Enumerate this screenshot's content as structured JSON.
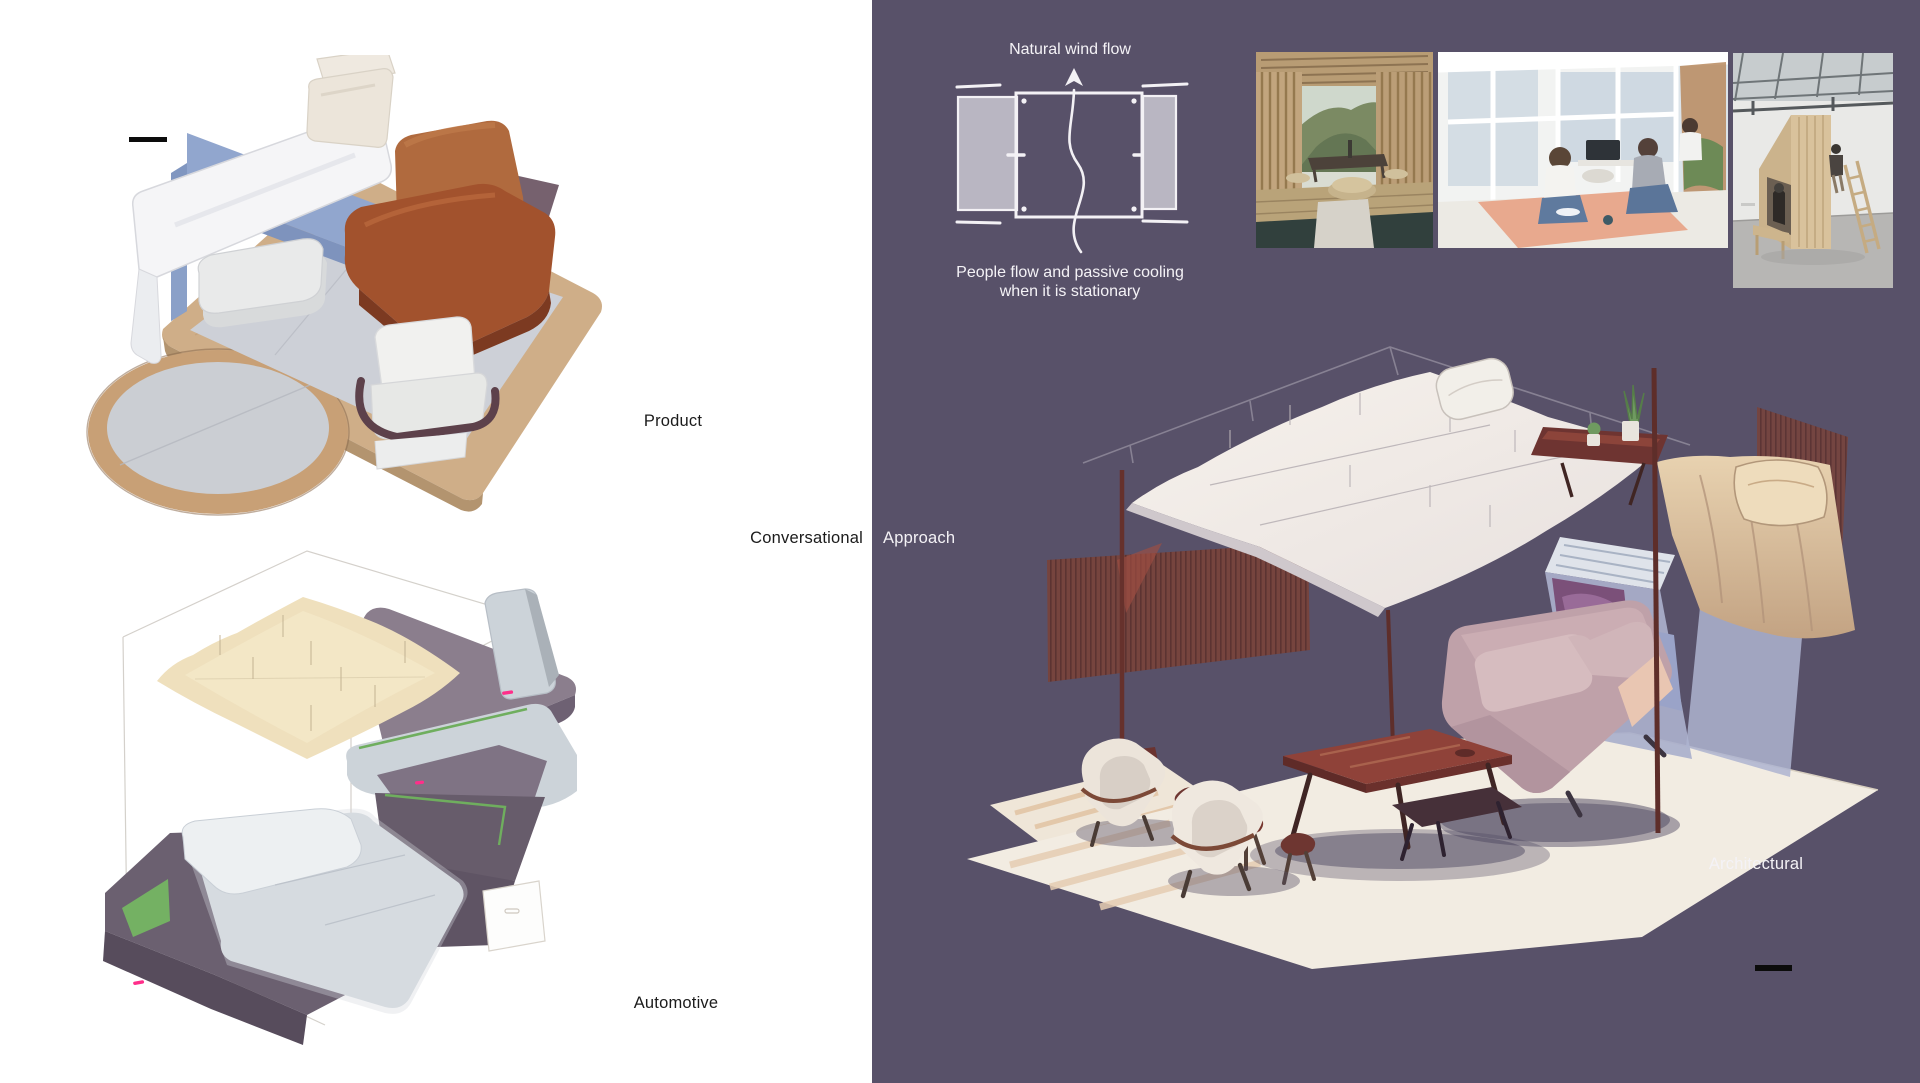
{
  "page": {
    "left_background": "#ffffff",
    "right_panel_background": "#585169"
  },
  "labels": {
    "product": "Product",
    "automotive": "Automotive",
    "architectural": "Architectural",
    "conversational": "Conversational",
    "approach": "Approach"
  },
  "wind_diagram": {
    "title": "Natural wind flow",
    "caption": [
      "People flow and passive cooling",
      "when it is stationary"
    ]
  },
  "photos": [
    {
      "name": "bamboo-pavilion-photo"
    },
    {
      "name": "glass-house-gathering-photo"
    },
    {
      "name": "plywood-hut-workshop-photo"
    }
  ],
  "palette": {
    "panel_purple": "#585169",
    "rust_mesh": "#7a4238",
    "caramel_leather": "#a2522d",
    "periwinkle_blue": "#91a6ce",
    "accent_green": "#6fae5e",
    "accent_magenta": "#ff2e8a",
    "canopy_cream": "#eedfb9",
    "wood_tan": "#cfae88",
    "sofa_mauve": "#bfa1a9",
    "table_red": "#8f4239",
    "ink_black": "#0c0c0c",
    "text_white": "#f4f2f6"
  }
}
